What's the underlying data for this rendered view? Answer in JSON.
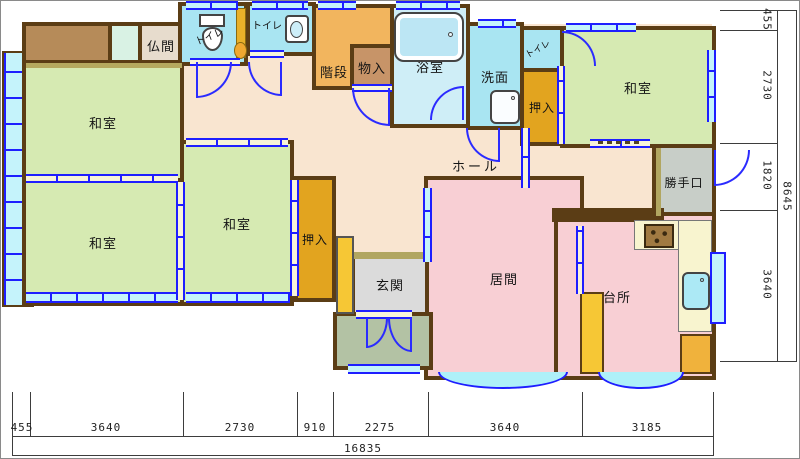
{
  "labels": {
    "washitsu": "和室",
    "butsuma": "仏間",
    "toilet": "トイレ",
    "kaidan": "階段",
    "monoire": "物入",
    "yokushitsu": "浴室",
    "senmen": "洗面",
    "oshiire": "押入",
    "hall": "ホール",
    "katteguchi": "勝手口",
    "genkan": "玄関",
    "ima": "居間",
    "daidokoro": "台所"
  },
  "dimensions": {
    "bottom": [
      "455",
      "3640",
      "2730",
      "910",
      "2275",
      "3640",
      "3185"
    ],
    "bottom_total": "16835",
    "right": [
      "455",
      "2730",
      "1820",
      "3640"
    ],
    "right_total": "8645"
  },
  "colors": {
    "wall": "#5b3d15",
    "tatami_green": "#d6eab2",
    "hall_peach": "#f9e5d0",
    "living_pink": "#f8cfd4",
    "stairs_orange": "#f2b55e",
    "closet_orange": "#e2a41f",
    "water_cyan": "#a9e5f2",
    "bath_cyan": "#cfeef7",
    "window_blue": "#1e1eff",
    "gray_katteguchi": "#c8cec8",
    "gray_genkan": "#dbdbdb",
    "porch_green": "#b3c2a4",
    "counter_cream": "#f8f4cf"
  }
}
